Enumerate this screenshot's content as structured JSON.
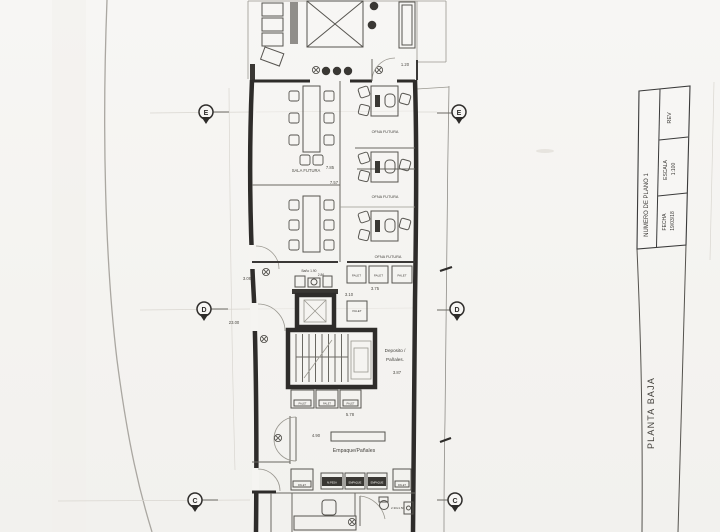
{
  "sheet": {
    "title": "PLANTA BAJA",
    "title_block": {
      "numero": "NUMERO DE PLANO 1",
      "rev_label": "REV",
      "escala_label": "ESCALA",
      "escala_value": "1:100",
      "fecha_label": "FECHA",
      "fecha_value": "19/03/18"
    }
  },
  "grid": {
    "letters": [
      "E",
      "D",
      "C"
    ]
  },
  "rooms": {
    "sala_futura": "SALA FUTURA",
    "ofna_futura": "OFNA FUTURA",
    "deposito_line1": "Deposito /",
    "deposito_line2": "Pañales.",
    "empaque_panales": "Empaque/Pañales",
    "bano": "Baño 1.90"
  },
  "boxes": {
    "palet": "PALET",
    "mpesa": "M.PESA",
    "empaque": "EMPAQUE"
  },
  "dims": [
    "1.20",
    "7.85",
    "7.57",
    "23.00",
    "3.09",
    "2.86",
    "3.75",
    "3.10",
    "3.87",
    "5.78",
    "4.90",
    "2.30x1.50"
  ],
  "colors": {
    "ink": "#2e2c2a",
    "paper": "#f5f4f1"
  }
}
